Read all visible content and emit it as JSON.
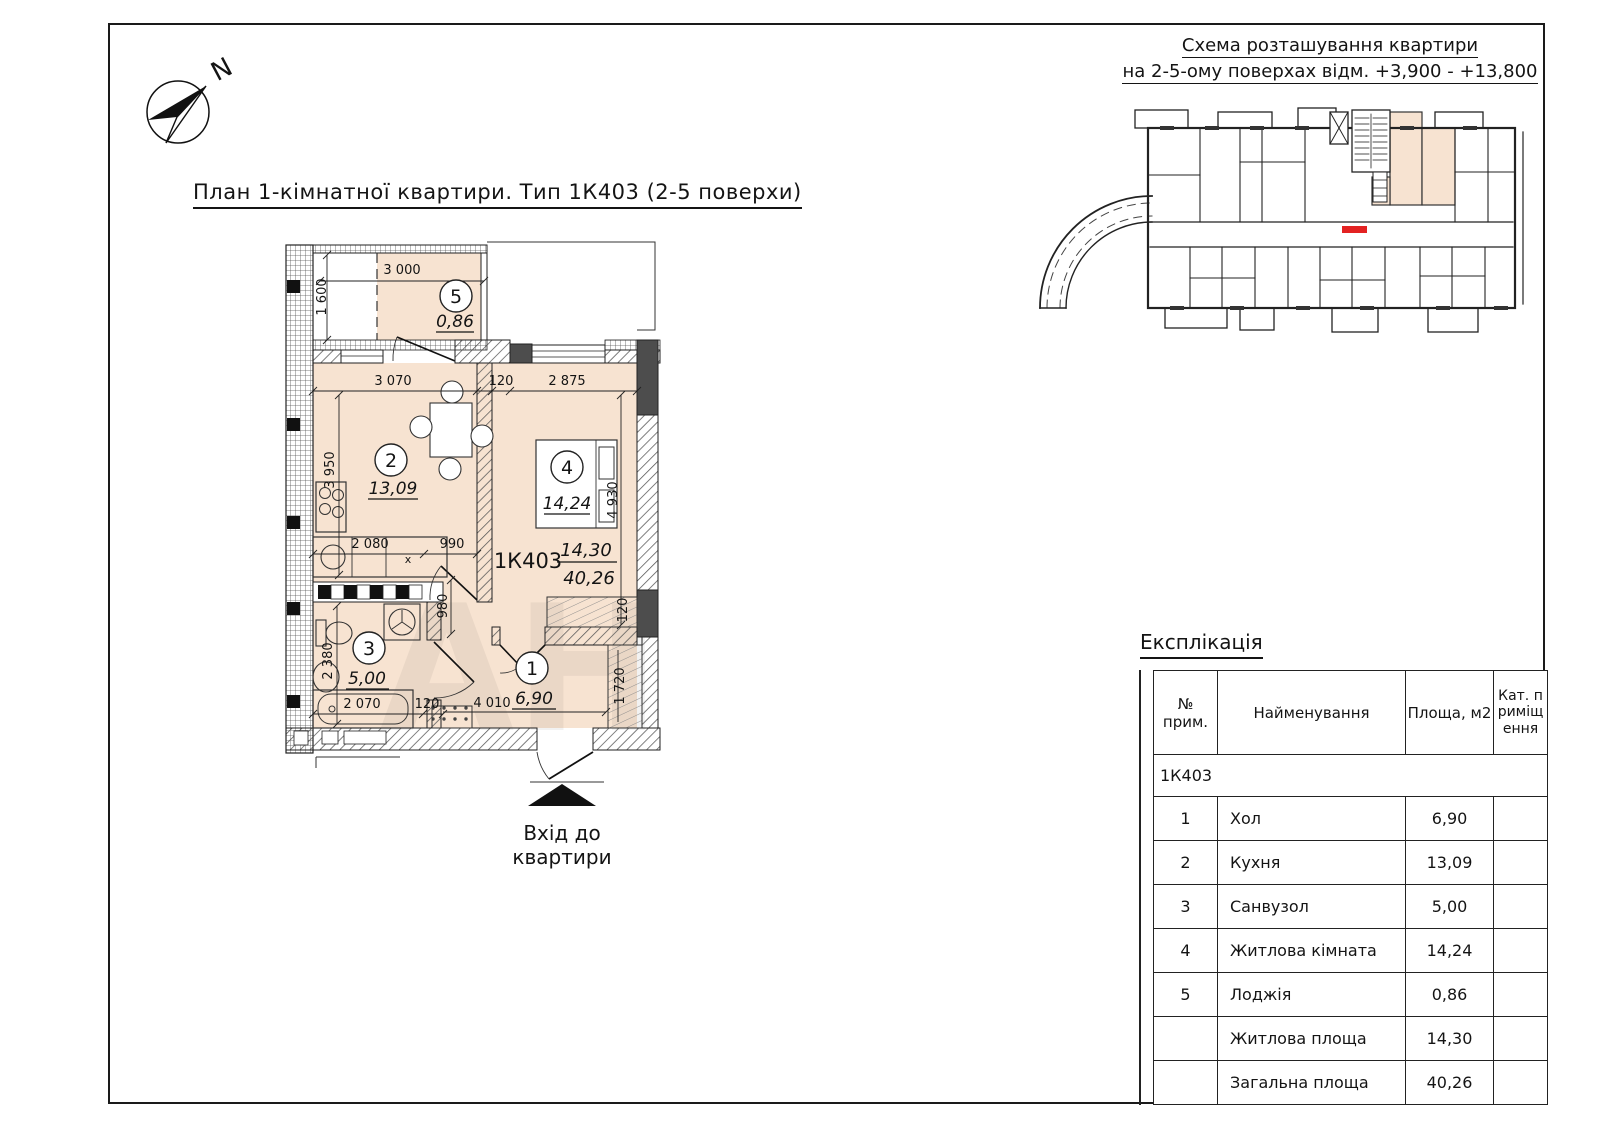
{
  "page": {
    "title": "План 1-кімнатної квартири. Тип 1К403 (2-5 поверхи)",
    "north_label": "N",
    "watermark": "АН"
  },
  "scheme": {
    "title_line1": "Схема розташування квартири",
    "title_line2": "на 2-5-ому поверхах відм. +3,900 - +13,800"
  },
  "plan": {
    "code": "1К403",
    "living_area": "14,30",
    "total_area": "40,26",
    "counter_mark": "x",
    "entry_line1": "Вхід до",
    "entry_line2": "квартири",
    "rooms": {
      "r1": {
        "num": "1",
        "area": "6,90"
      },
      "r2": {
        "num": "2",
        "area": "13,09"
      },
      "r3": {
        "num": "3",
        "area": "5,00"
      },
      "r4": {
        "num": "4",
        "area": "14,24"
      },
      "r5": {
        "num": "5",
        "area": "0,86"
      }
    },
    "dims": {
      "loggia_w": "3 000",
      "loggia_d": "1 600",
      "kitchen_w": "3 070",
      "wall120a": "120",
      "room4_w": "2 875",
      "kitchen_d": "3 950",
      "counter_w": "2 080",
      "pass_w": "990",
      "room4_d": "4 930",
      "niche_d": "980",
      "bath_d": "2 380",
      "bath_w": "2 070",
      "wall120b": "120",
      "hall_w": "4 010",
      "wall120c": "120",
      "wardrobe_d": "1 720"
    }
  },
  "explication": {
    "heading": "Експлікація",
    "col_no": "№ прим.",
    "col_name": "Найменування",
    "col_area": "Площа, м2",
    "col_cat": "Кат. приміщення",
    "group": "1К403",
    "rows": [
      {
        "no": "1",
        "name": "Хол",
        "area": "6,90",
        "cat": ""
      },
      {
        "no": "2",
        "name": "Кухня",
        "area": "13,09",
        "cat": ""
      },
      {
        "no": "3",
        "name": "Санвузол",
        "area": "5,00",
        "cat": ""
      },
      {
        "no": "4",
        "name": "Житлова кімната",
        "area": "14,24",
        "cat": ""
      },
      {
        "no": "5",
        "name": "Лоджія",
        "area": "0,86",
        "cat": ""
      }
    ],
    "totals": [
      {
        "name": "Житлова площа",
        "area": "14,30"
      },
      {
        "name": "Загальна площа",
        "area": "40,26"
      }
    ]
  },
  "colors": {
    "room_fill": "#f7e3d1",
    "marker_red": "#e32222",
    "pier_dark": "#4d4d4d"
  }
}
